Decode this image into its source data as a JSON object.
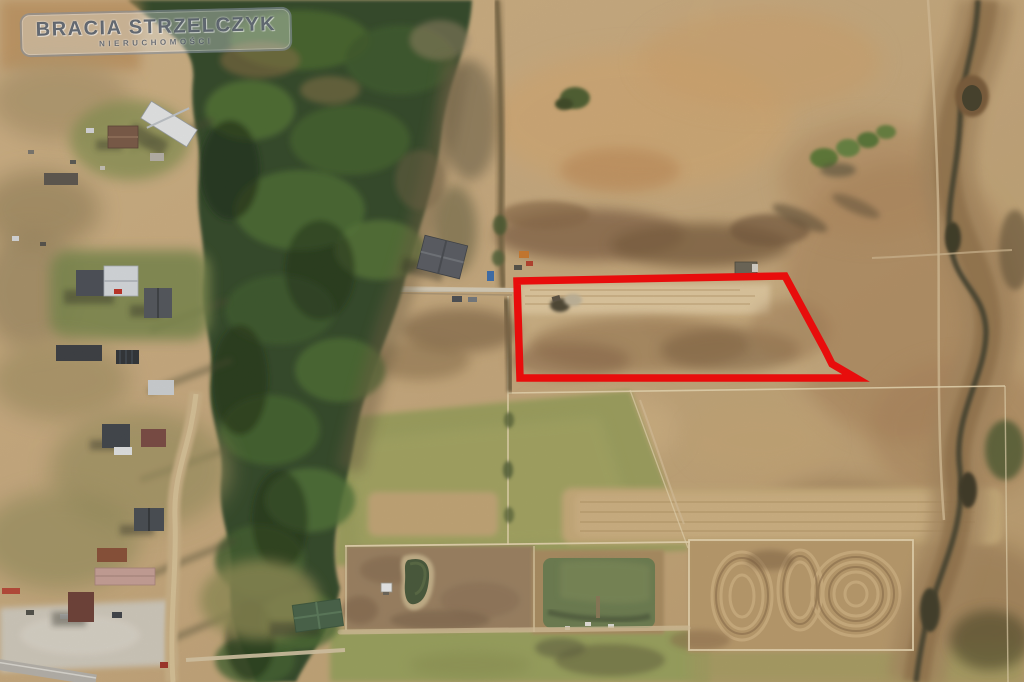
{
  "watermark": {
    "line1": "BRACIA STRZELCZYK",
    "line2": "NIERUCHOMOŚCI"
  },
  "overlay": {
    "plot_outline_points": "517,281 785,276 825,350 832,364 856,378 520,378",
    "outline_color": "#e80d0c",
    "outline_width": "7.5"
  },
  "colors": {
    "dry_meadow_tan": "#cfb083",
    "light_sand": "#e2cba2",
    "dark_scrub_brown": "#7c5f41",
    "green_field_olive": "#9ea260",
    "forest_green": "#2e4526",
    "pond_water_green": "#6d7f53",
    "stream_water_dark": "#494430",
    "road_gray": "#bdb8ae"
  }
}
